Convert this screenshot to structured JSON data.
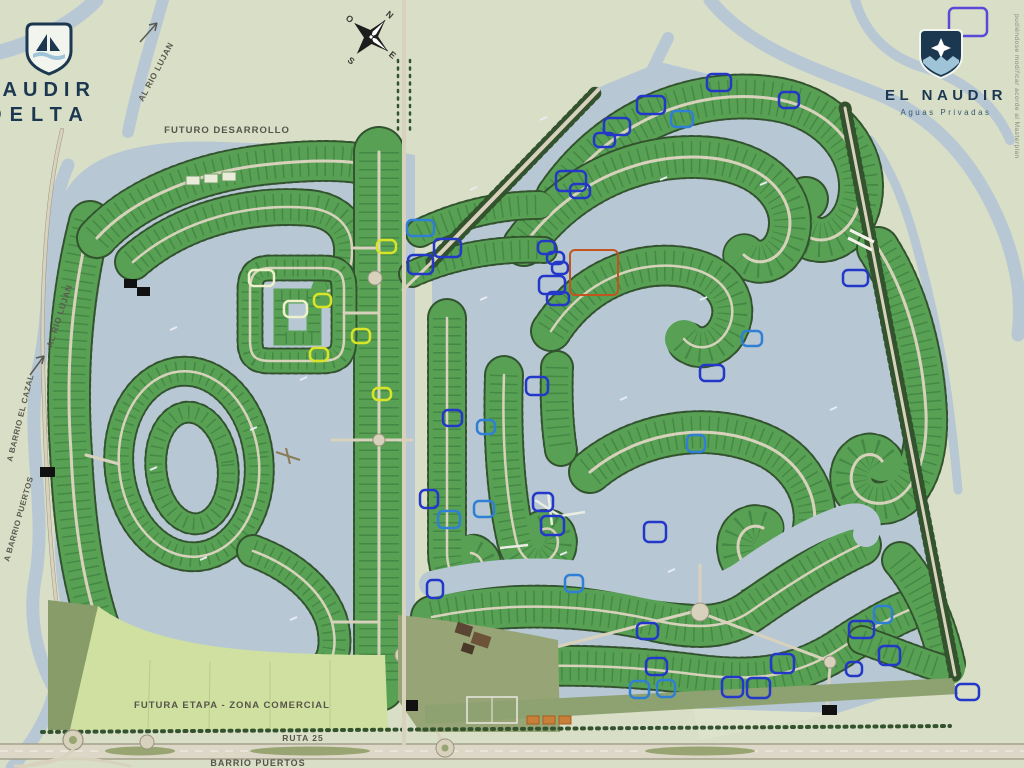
{
  "branding": {
    "left_logo": {
      "line1": "NAUDIR",
      "line2": "DELTA",
      "icon": "sailboat-shield-icon"
    },
    "right_logo": {
      "line1": "EL NAUDIR",
      "line2": "Aguas Privadas",
      "icon": "star-shield-icon"
    }
  },
  "labels": {
    "futuro_desarrollo": "FUTURO DESARROLLO",
    "futura_etapa": "FUTURA ETAPA - ZONA COMERCIAL",
    "ruta": "RUTA 25",
    "barrio_puertos": "BARRIO PUERTOS",
    "al_rio_lujan_top": "AL RIO LUJAN",
    "al_rio_lujan_left": "AL RIO LUJAN",
    "a_barrio_cazal": "A BARRIO EL CAZAL",
    "a_barrio_puertos": "A BARRIO PUERTOS"
  },
  "disclaimer": "pudiéndose modificar acorde al Masterplan",
  "compass": {
    "n": "N",
    "e": "E",
    "s": "S",
    "o": "O"
  },
  "colors": {
    "background": "#d9dec7",
    "water": "#b7c8d4",
    "lot_green": "#58a154",
    "tree_dark": "#33522e",
    "road": "#d8d2bd",
    "olive": "#8ea271",
    "futura_etapa_green": "#cfe0a0",
    "logo_navy": "#1c3850",
    "marker_blue": "#2338c8",
    "marker_teal": "#2f7fd4",
    "marker_yellow": "#d9e428",
    "marker_pale": "#eef2cc",
    "marker_red": "#c2551d",
    "marker_violet": "#5a49d8"
  },
  "markers": [
    {
      "x": 949,
      "y": 8,
      "w": 38,
      "h": 28,
      "type": "violet"
    },
    {
      "x": 707,
      "y": 74,
      "w": 24,
      "h": 17,
      "type": "blue"
    },
    {
      "x": 637,
      "y": 96,
      "w": 28,
      "h": 18,
      "type": "blue"
    },
    {
      "x": 779,
      "y": 92,
      "w": 20,
      "h": 16,
      "type": "blue"
    },
    {
      "x": 604,
      "y": 118,
      "w": 26,
      "h": 17,
      "type": "blue"
    },
    {
      "x": 594,
      "y": 133,
      "w": 21,
      "h": 14,
      "type": "blue"
    },
    {
      "x": 671,
      "y": 111,
      "w": 22,
      "h": 16,
      "type": "teal"
    },
    {
      "x": 556,
      "y": 171,
      "w": 30,
      "h": 20,
      "type": "blue"
    },
    {
      "x": 570,
      "y": 184,
      "w": 20,
      "h": 14,
      "type": "blue"
    },
    {
      "x": 843,
      "y": 270,
      "w": 25,
      "h": 16,
      "type": "blue"
    },
    {
      "x": 742,
      "y": 331,
      "w": 20,
      "h": 15,
      "type": "teal"
    },
    {
      "x": 700,
      "y": 365,
      "w": 24,
      "h": 16,
      "type": "blue"
    },
    {
      "x": 538,
      "y": 241,
      "w": 17,
      "h": 13,
      "type": "blue"
    },
    {
      "x": 547,
      "y": 252,
      "w": 17,
      "h": 12,
      "type": "blue"
    },
    {
      "x": 552,
      "y": 262,
      "w": 16,
      "h": 12,
      "type": "blue"
    },
    {
      "x": 539,
      "y": 276,
      "w": 26,
      "h": 18,
      "type": "blue"
    },
    {
      "x": 547,
      "y": 292,
      "w": 22,
      "h": 13,
      "type": "blue"
    },
    {
      "x": 434,
      "y": 239,
      "w": 27,
      "h": 18,
      "type": "blue"
    },
    {
      "x": 408,
      "y": 255,
      "w": 25,
      "h": 19,
      "type": "blue"
    },
    {
      "x": 407,
      "y": 220,
      "w": 27,
      "h": 16,
      "type": "teal"
    },
    {
      "x": 377,
      "y": 240,
      "w": 19,
      "h": 13,
      "type": "yellow"
    },
    {
      "x": 526,
      "y": 377,
      "w": 22,
      "h": 18,
      "type": "blue"
    },
    {
      "x": 443,
      "y": 410,
      "w": 19,
      "h": 16,
      "type": "blue"
    },
    {
      "x": 477,
      "y": 420,
      "w": 18,
      "h": 14,
      "type": "teal"
    },
    {
      "x": 420,
      "y": 490,
      "w": 18,
      "h": 18,
      "type": "blue"
    },
    {
      "x": 438,
      "y": 511,
      "w": 22,
      "h": 17,
      "type": "teal"
    },
    {
      "x": 474,
      "y": 501,
      "w": 20,
      "h": 16,
      "type": "teal"
    },
    {
      "x": 533,
      "y": 493,
      "w": 20,
      "h": 18,
      "type": "blue"
    },
    {
      "x": 541,
      "y": 516,
      "w": 23,
      "h": 19,
      "type": "blue"
    },
    {
      "x": 644,
      "y": 522,
      "w": 22,
      "h": 20,
      "type": "blue"
    },
    {
      "x": 687,
      "y": 435,
      "w": 18,
      "h": 17,
      "type": "teal"
    },
    {
      "x": 565,
      "y": 575,
      "w": 18,
      "h": 17,
      "type": "teal"
    },
    {
      "x": 427,
      "y": 580,
      "w": 16,
      "h": 18,
      "type": "blue"
    },
    {
      "x": 637,
      "y": 623,
      "w": 21,
      "h": 16,
      "type": "blue"
    },
    {
      "x": 646,
      "y": 658,
      "w": 21,
      "h": 17,
      "type": "blue"
    },
    {
      "x": 630,
      "y": 681,
      "w": 19,
      "h": 17,
      "type": "teal"
    },
    {
      "x": 657,
      "y": 680,
      "w": 18,
      "h": 17,
      "type": "teal"
    },
    {
      "x": 722,
      "y": 677,
      "w": 21,
      "h": 20,
      "type": "blue"
    },
    {
      "x": 747,
      "y": 678,
      "w": 23,
      "h": 20,
      "type": "blue"
    },
    {
      "x": 771,
      "y": 654,
      "w": 23,
      "h": 19,
      "type": "blue"
    },
    {
      "x": 849,
      "y": 621,
      "w": 25,
      "h": 17,
      "type": "blue"
    },
    {
      "x": 874,
      "y": 606,
      "w": 18,
      "h": 17,
      "type": "teal"
    },
    {
      "x": 846,
      "y": 662,
      "w": 16,
      "h": 14,
      "type": "blue"
    },
    {
      "x": 879,
      "y": 646,
      "w": 21,
      "h": 19,
      "type": "blue"
    },
    {
      "x": 956,
      "y": 684,
      "w": 23,
      "h": 16,
      "type": "blue"
    },
    {
      "x": 249,
      "y": 270,
      "w": 25,
      "h": 16,
      "type": "pale"
    },
    {
      "x": 284,
      "y": 301,
      "w": 23,
      "h": 16,
      "type": "pale"
    },
    {
      "x": 314,
      "y": 294,
      "w": 17,
      "h": 13,
      "type": "yellow"
    },
    {
      "x": 352,
      "y": 329,
      "w": 18,
      "h": 14,
      "type": "yellow"
    },
    {
      "x": 310,
      "y": 348,
      "w": 18,
      "h": 13,
      "type": "yellow"
    },
    {
      "x": 373,
      "y": 388,
      "w": 18,
      "h": 12,
      "type": "yellow"
    },
    {
      "x": 570,
      "y": 250,
      "w": 48,
      "h": 45,
      "type": "red"
    }
  ]
}
